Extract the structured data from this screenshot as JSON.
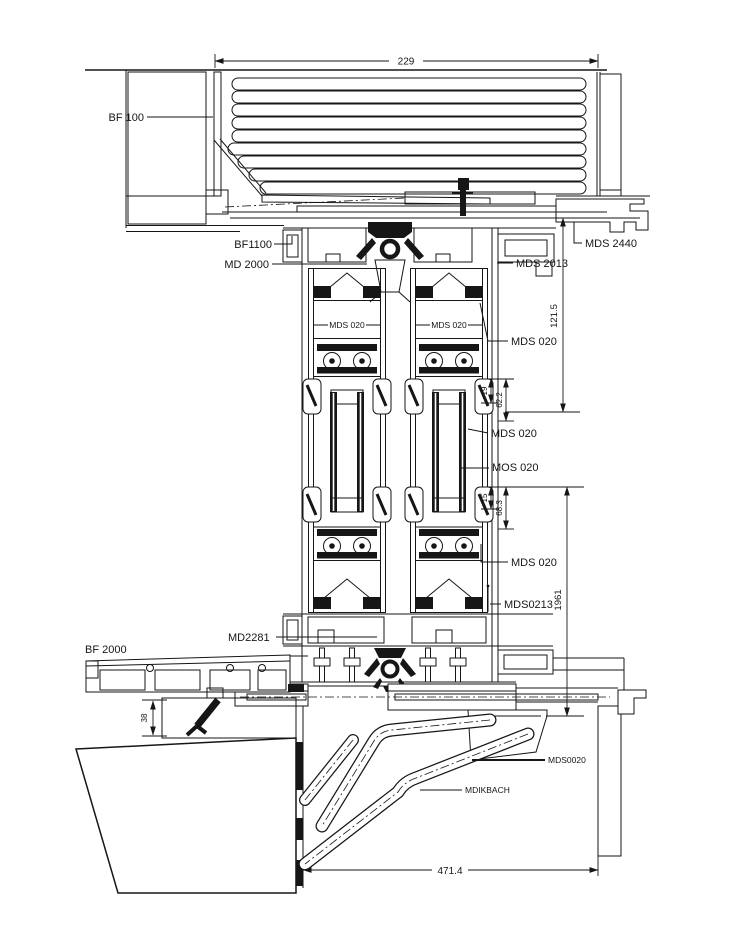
{
  "drawing": {
    "type": "window-facade-vertical-section-detail",
    "component_labels": {
      "bf100": "BF 100",
      "bf1100": "BF1100",
      "md2000": "MD 2000",
      "mds2440": "MDS 2440",
      "mds2013": "MDS 2013",
      "mds020_sash_left": "MDS 020",
      "mds020_sash_right": "MDS 020",
      "mds020_frame": "MDS 020",
      "mds020_glazing_upper": "MDS 020",
      "mos020_glazing_lower": "MOS 020",
      "mds020_sash_lower": "MDS 020",
      "mds0213": "MDS0213",
      "md2281": "MD2281",
      "bf2000": "BF 2000",
      "mds0020": "MDS0020",
      "mdikbach": "MDIKBACH"
    },
    "dimensions": {
      "shutter_box_width": "229",
      "frame_head_height": "121.5",
      "glazing_top_small": "19",
      "glazing_top_large": "62.2",
      "glazing_bottom_small": "15",
      "glazing_bottom_large": "68.3",
      "panel_height": "1961",
      "sill_upstand": "38",
      "bracket_span": "471.4"
    }
  }
}
